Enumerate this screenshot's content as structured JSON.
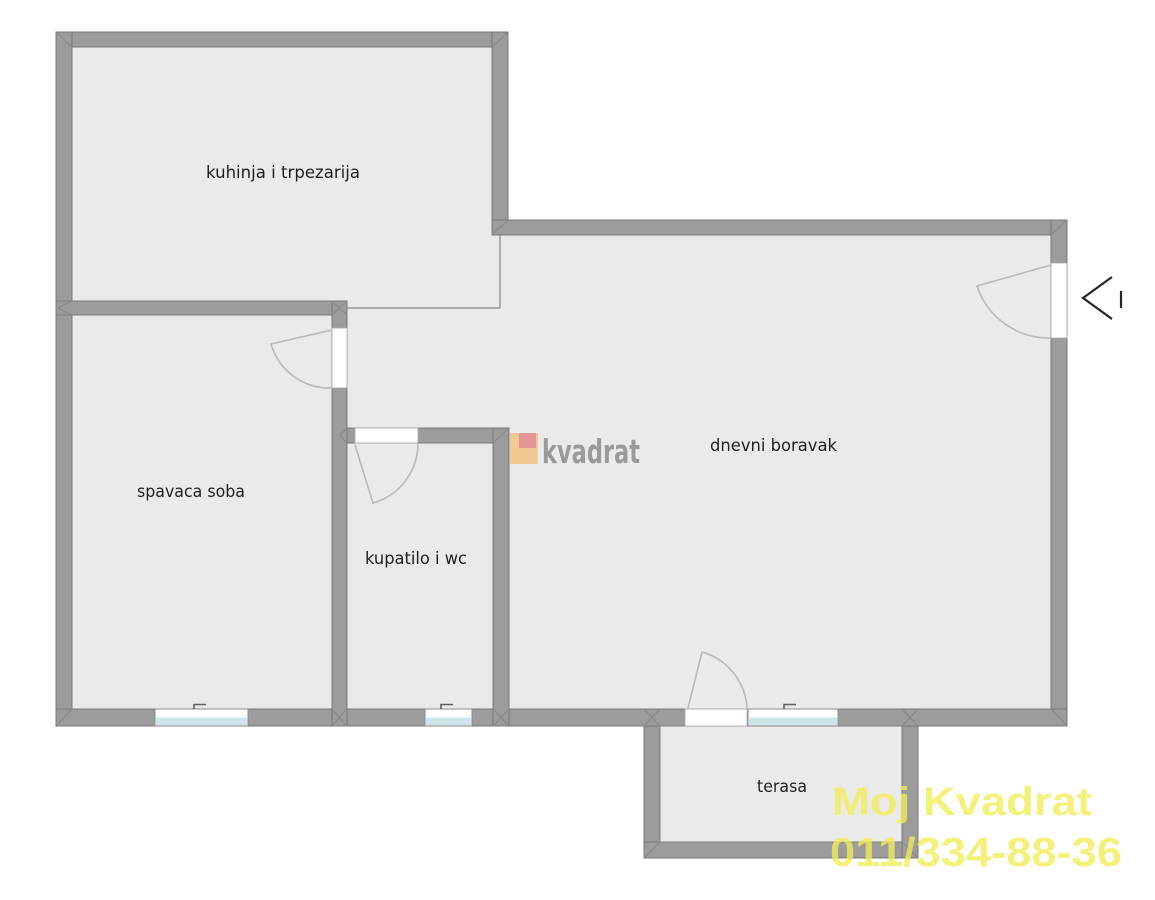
{
  "plan": {
    "rooms": [
      {
        "id": "kitchen",
        "label": "kuhinja i trpezarija"
      },
      {
        "id": "bedroom",
        "label": "spavaca soba"
      },
      {
        "id": "bathroom",
        "label": "kupatilo i wc"
      },
      {
        "id": "living-room",
        "label": "dnevni boravak"
      },
      {
        "id": "terrace",
        "label": "terasa"
      }
    ]
  },
  "watermarks": {
    "center_logo": {
      "text": "kvadrat"
    },
    "agency": {
      "line1": "Moj Kvadrat",
      "line2": "011/334-88-36"
    }
  },
  "colors": {
    "background": "#ffffff",
    "floor": "#eaeaea",
    "wall": "#9c9c9c",
    "wall_edge": "#787878",
    "seam": "#848484",
    "open_boundary": "#858585",
    "opening_frame": "#a8a8a8",
    "window_glass": "#cfe4e9",
    "door_arc": "#b9b9b9",
    "handle": "#5f5f5f",
    "label_text": "#1f1f1f",
    "logo_orange": "#f3c993",
    "logo_pink": "#e59497",
    "logo_text_gray": "#9a9a9a",
    "watermark_yellow": "#f1ee55",
    "entry_arrow": "#262626"
  }
}
